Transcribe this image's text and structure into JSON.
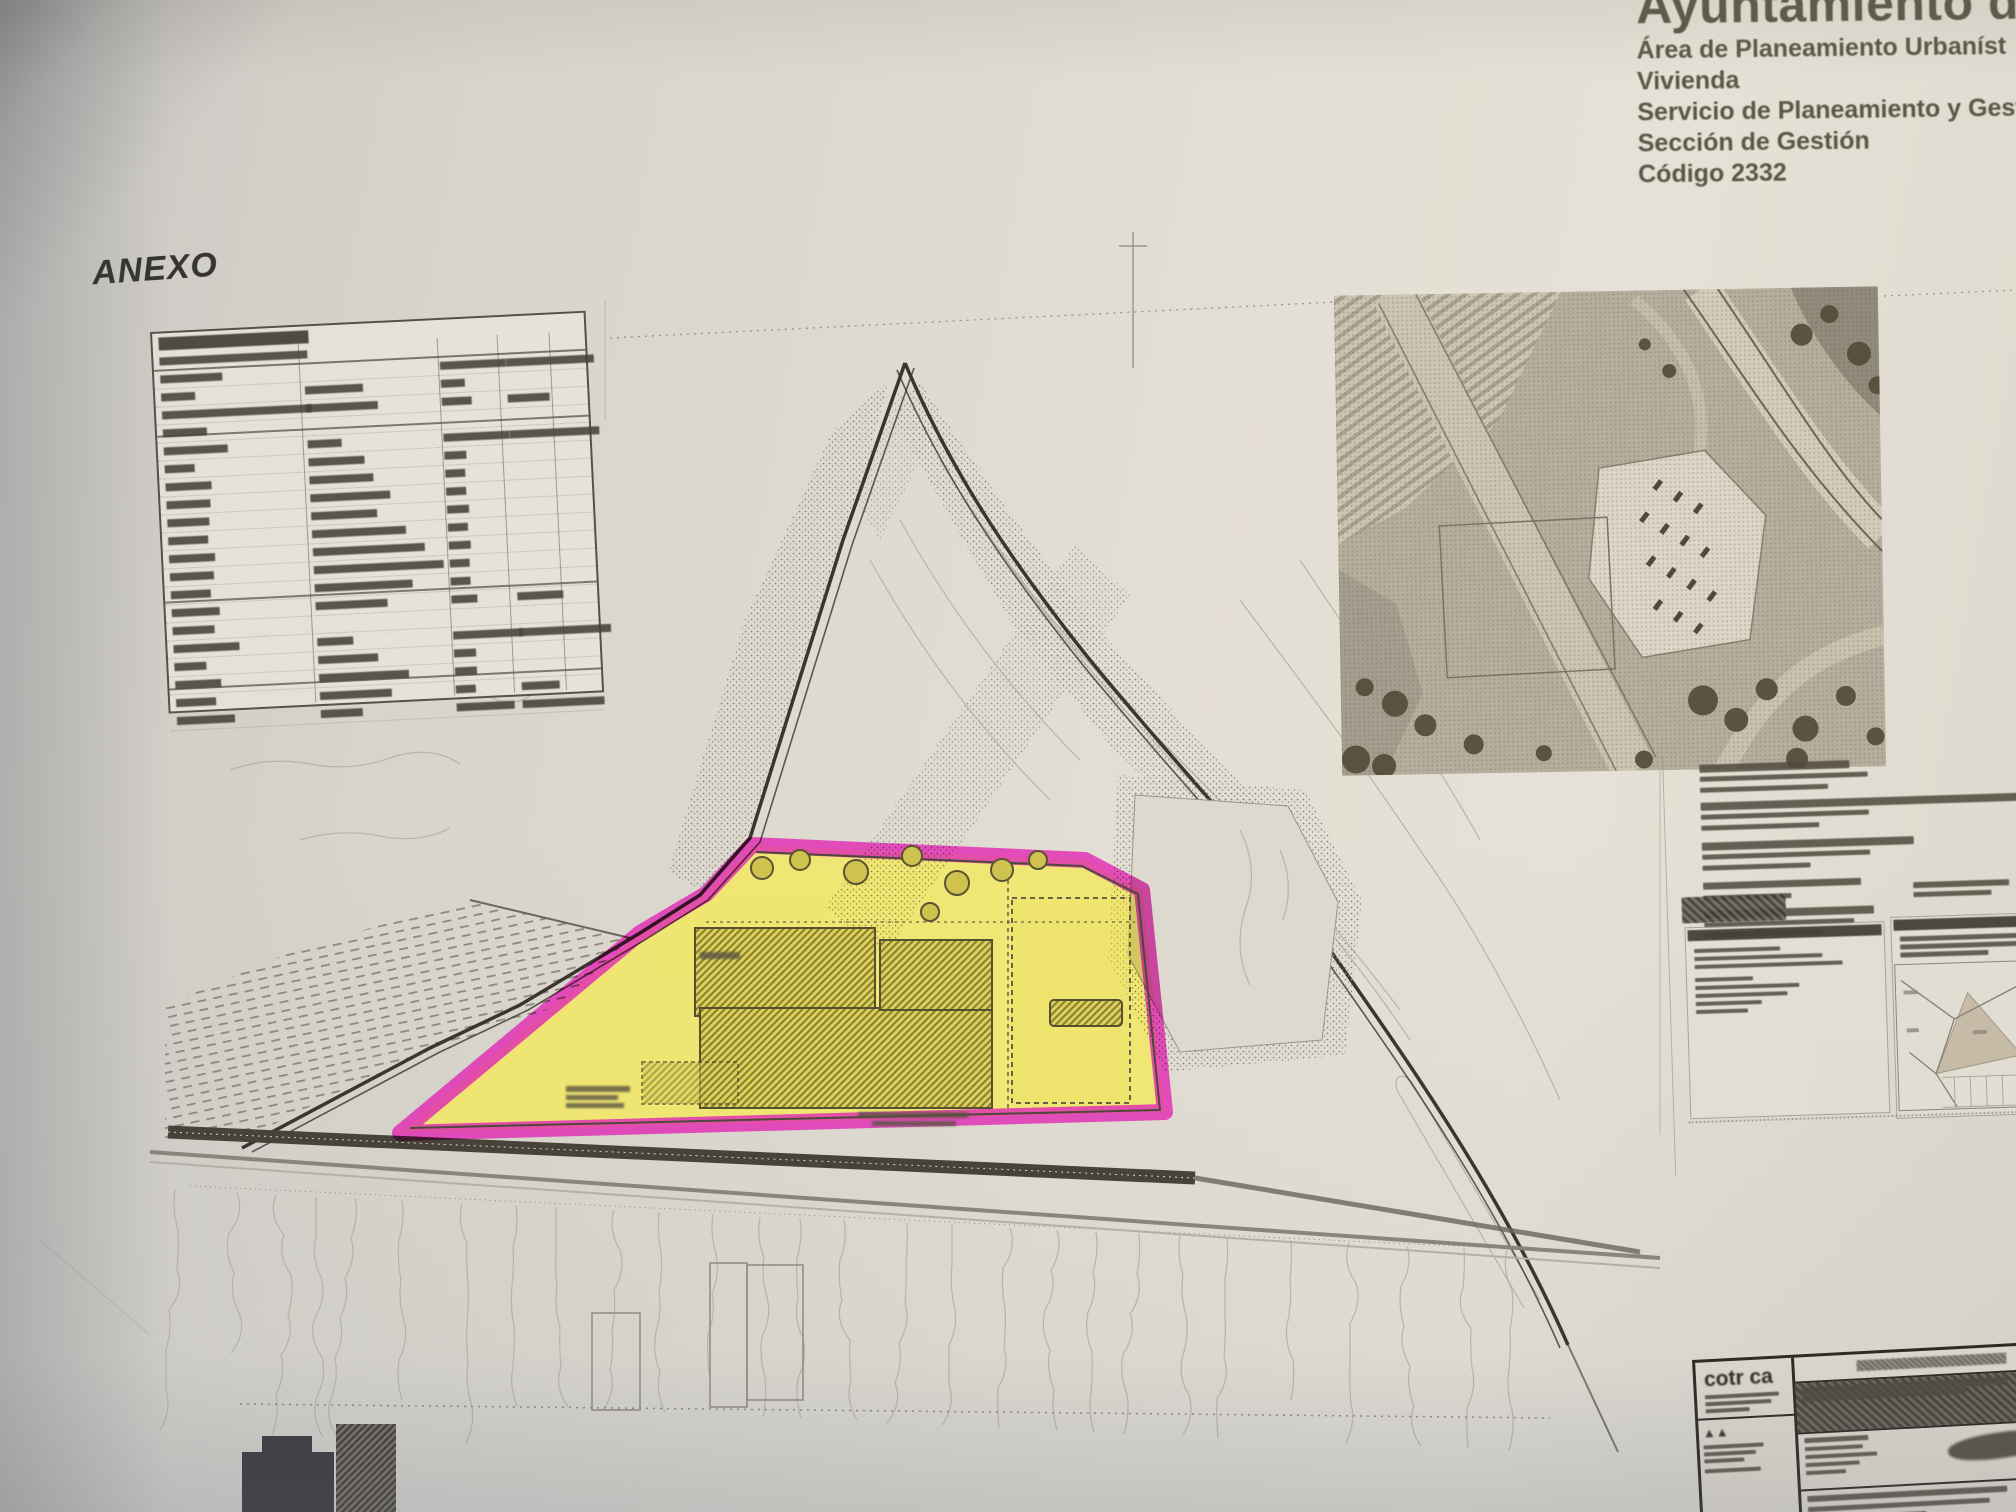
{
  "document": {
    "header": {
      "municipality": "Ayuntamiento de",
      "department": "Área de Planeamiento Urbaníst",
      "vivienda": "Vivienda",
      "service": "Servicio de Planeamiento y Gesti",
      "section": "Sección de Gestión",
      "code": "Código 2332"
    },
    "annex_label": "ANEXO",
    "title_block": {
      "logo": "cotr ca"
    }
  },
  "colors": {
    "highlight_magenta": "#e02cb4",
    "highlight_yellow": "#f1e765",
    "ink_dark": "#3a362f",
    "contour_gray": "#b2ada3",
    "paper": "#e3ded3"
  },
  "surface_table": {
    "rows": [
      [
        148,
        0,
        0,
        0
      ],
      [
        62,
        0,
        66,
        88
      ],
      [
        34,
        58,
        24,
        0
      ],
      [
        150,
        72,
        30,
        42
      ],
      [
        44,
        0,
        0,
        0
      ],
      [
        64,
        34,
        66,
        90
      ],
      [
        30,
        56,
        22,
        0
      ],
      [
        46,
        64,
        20,
        0
      ],
      [
        44,
        80,
        20,
        0
      ],
      [
        42,
        66,
        22,
        0
      ],
      [
        40,
        94,
        20,
        0
      ],
      [
        46,
        112,
        22,
        0
      ],
      [
        44,
        130,
        20,
        0
      ],
      [
        40,
        98,
        20,
        0
      ],
      [
        48,
        72,
        26,
        46
      ],
      [
        42,
        0,
        0,
        0
      ],
      [
        66,
        36,
        70,
        92
      ],
      [
        32,
        60,
        22,
        0
      ],
      [
        46,
        90,
        22,
        0
      ],
      [
        40,
        72,
        20,
        38
      ],
      [
        58,
        42,
        58,
        82
      ]
    ]
  },
  "placeholders": {
    "cadastral_text_lines": [
      [
        150,
        8,
        4
      ],
      [
        168,
        5,
        6
      ],
      [
        128,
        5,
        10
      ],
      [
        322,
        8,
        4
      ],
      [
        168,
        5,
        6
      ],
      [
        118,
        5,
        12
      ],
      [
        212,
        8,
        4
      ],
      [
        168,
        5,
        6
      ],
      [
        108,
        5,
        12
      ],
      [
        158,
        7,
        6
      ],
      [
        88,
        5,
        10
      ],
      [
        170,
        8,
        4
      ],
      [
        150,
        5,
        5
      ],
      [
        118,
        5,
        4
      ]
    ],
    "panel_left_lines": [
      [
        86,
        4,
        4
      ],
      [
        128,
        4,
        4
      ],
      [
        148,
        4,
        9
      ],
      [
        58,
        4,
        4
      ],
      [
        104,
        4,
        4
      ],
      [
        92,
        4,
        4
      ],
      [
        66,
        4,
        4
      ],
      [
        52,
        4,
        4
      ]
    ],
    "panel_right_lines": [
      [
        118,
        5,
        3
      ],
      [
        126,
        5,
        3
      ],
      [
        88,
        5,
        3
      ]
    ],
    "stamp_right_lines": [
      [
        96,
        6,
        4
      ],
      [
        78,
        5,
        4
      ]
    ],
    "logo_sub_lines": [
      [
        74,
        4,
        3
      ],
      [
        66,
        4,
        3
      ],
      [
        44,
        4,
        3
      ]
    ],
    "arch_lines": [
      [
        60,
        4,
        3
      ],
      [
        52,
        4,
        3
      ],
      [
        40,
        4,
        6
      ],
      [
        56,
        4,
        3
      ]
    ],
    "titleblock_band_lines": [
      [
        206,
        8,
        0
      ],
      [
        164,
        7,
        0
      ]
    ],
    "titleblock_info_lines": [
      [
        64,
        5,
        4
      ],
      [
        58,
        4,
        4
      ],
      [
        72,
        4,
        4
      ],
      [
        54,
        4,
        4
      ],
      [
        40,
        4,
        0
      ]
    ],
    "titleblock_bottom_lines": [
      [
        200,
        6,
        5
      ],
      [
        182,
        5,
        5
      ],
      [
        118,
        5,
        0
      ]
    ]
  }
}
